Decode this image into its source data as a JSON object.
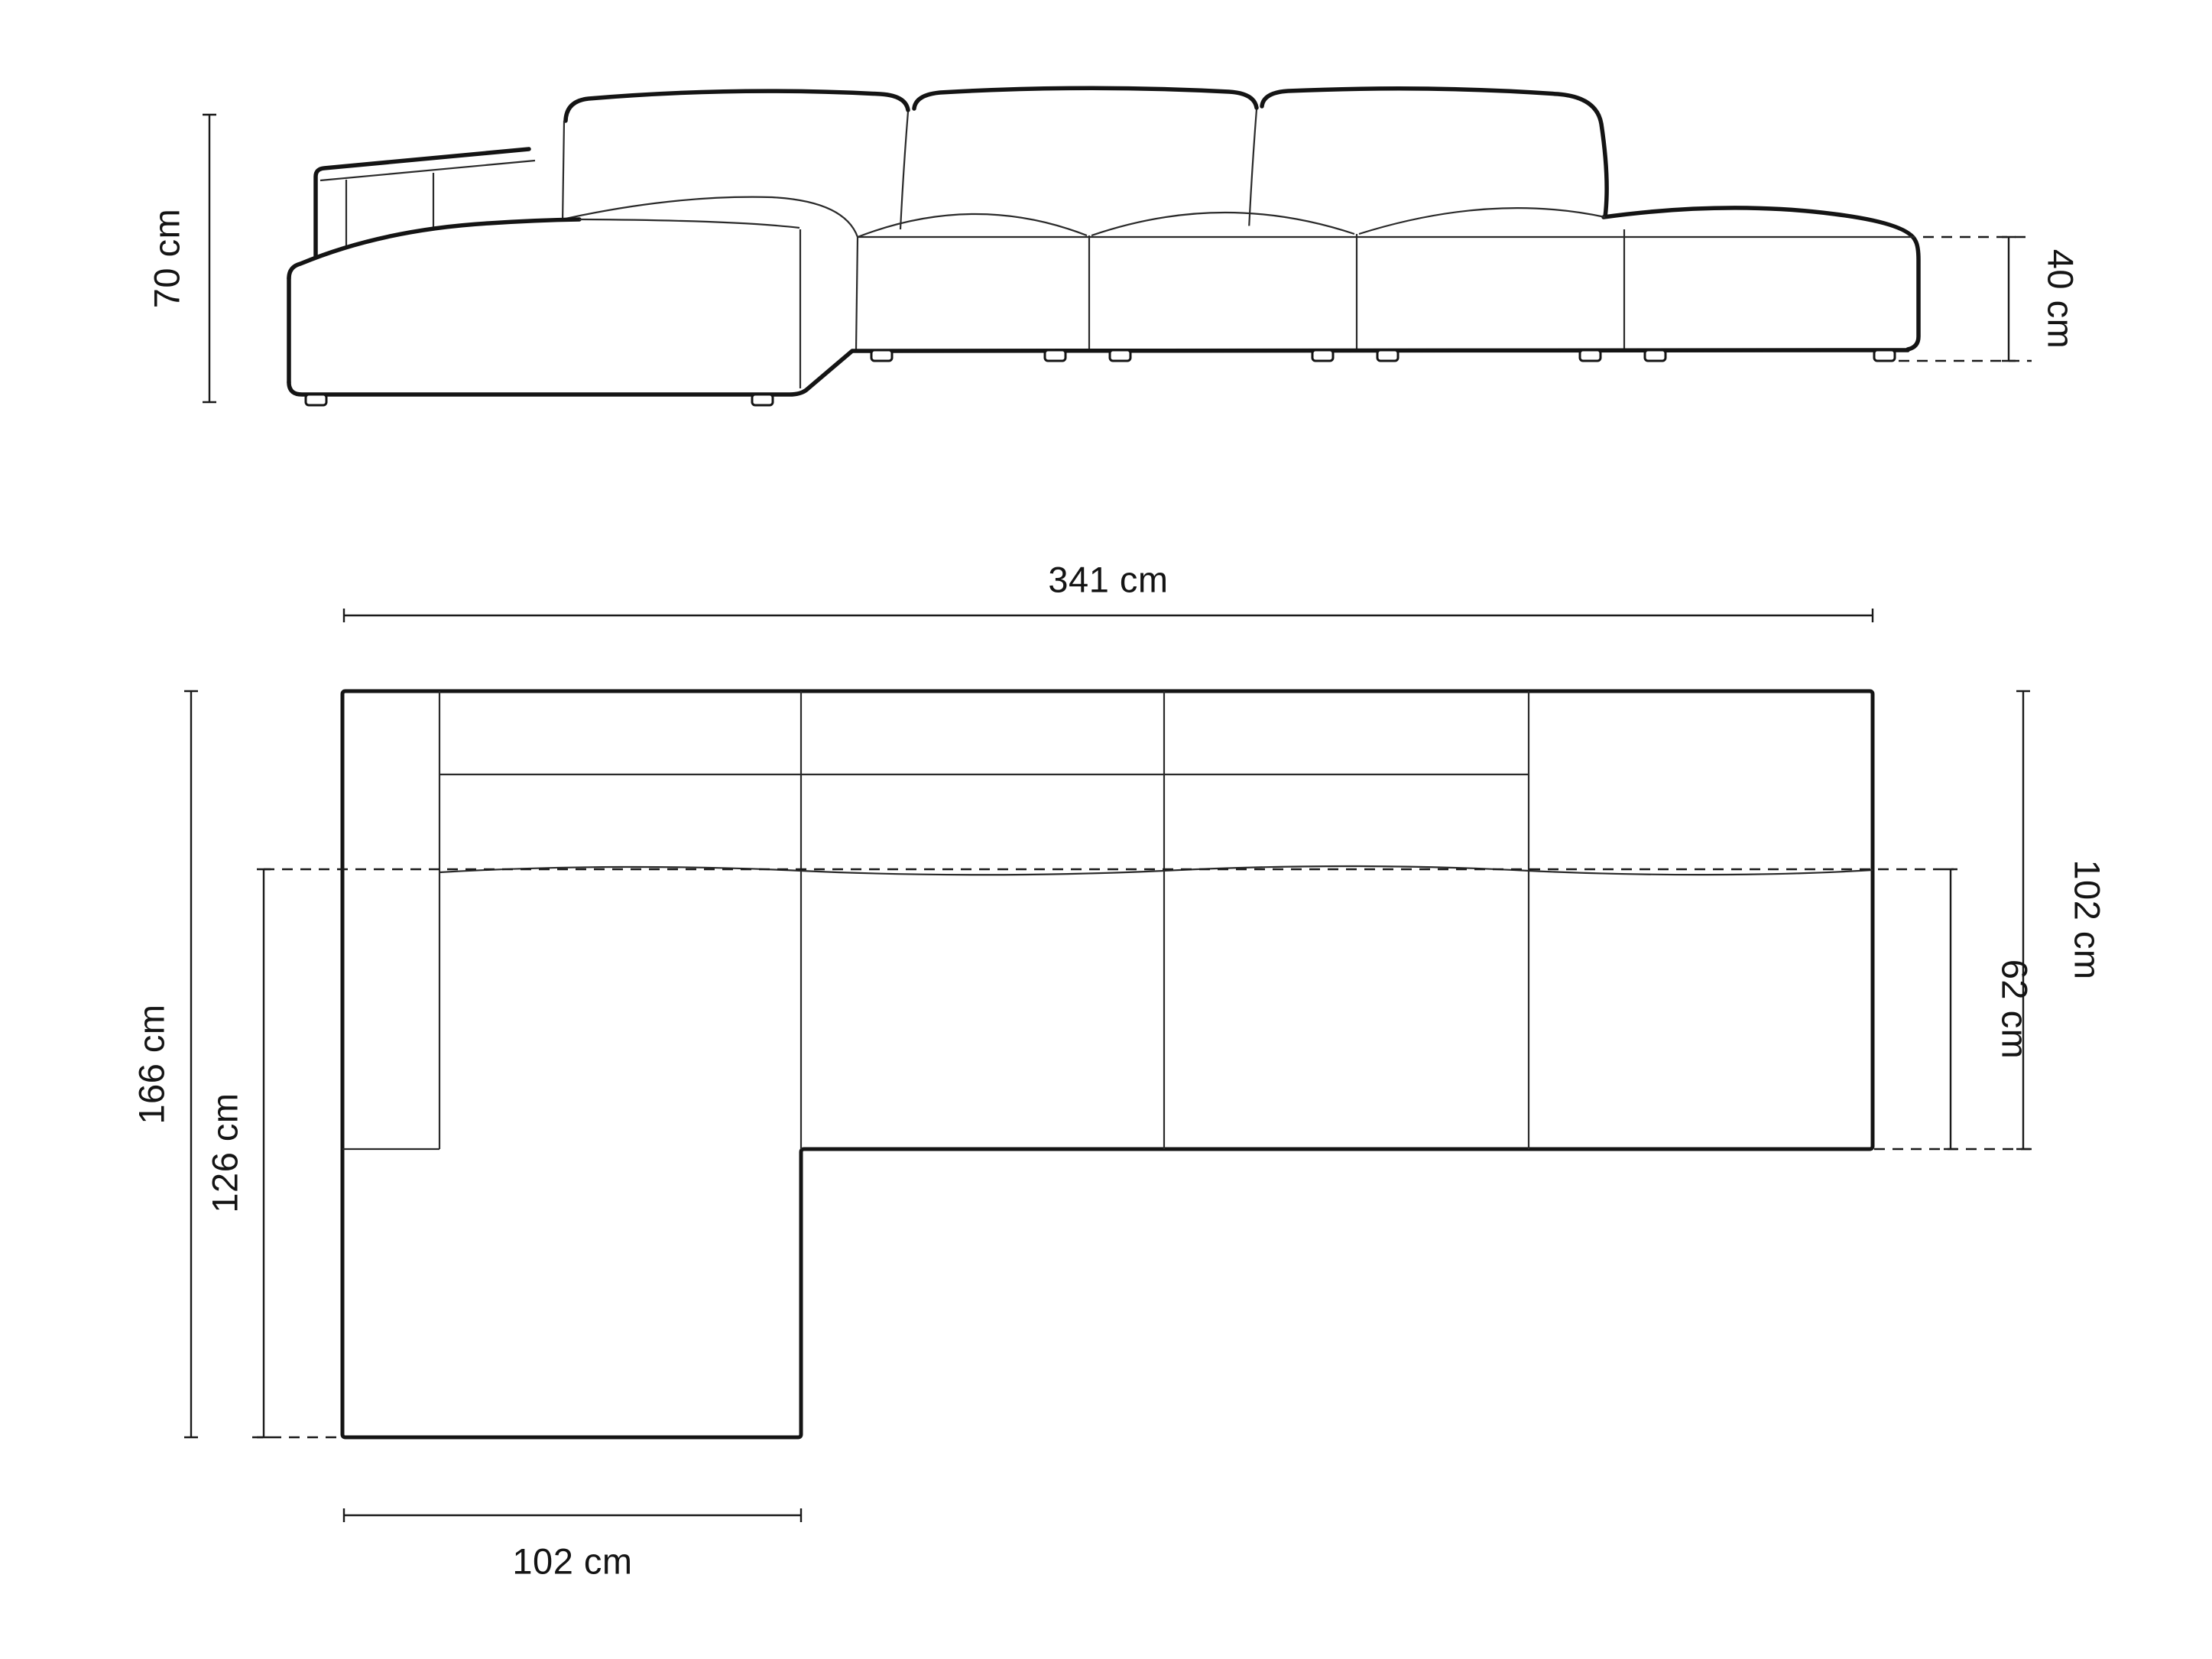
{
  "meta": {
    "drawing_type": "sofa technical dimension diagram",
    "views": [
      "side elevation",
      "top plan"
    ],
    "background_color": "#ffffff",
    "line_color": "#141414"
  },
  "elevation": {
    "height_label": "70 cm",
    "ottoman_height_label": "40 cm"
  },
  "plan": {
    "total_width_label": "341 cm",
    "total_depth_label": "166 cm",
    "chaise_inner_depth_label": "126 cm",
    "right_depth_label": "102 cm",
    "seat_depth_label": "62 cm",
    "chaise_width_label": "102 cm"
  }
}
